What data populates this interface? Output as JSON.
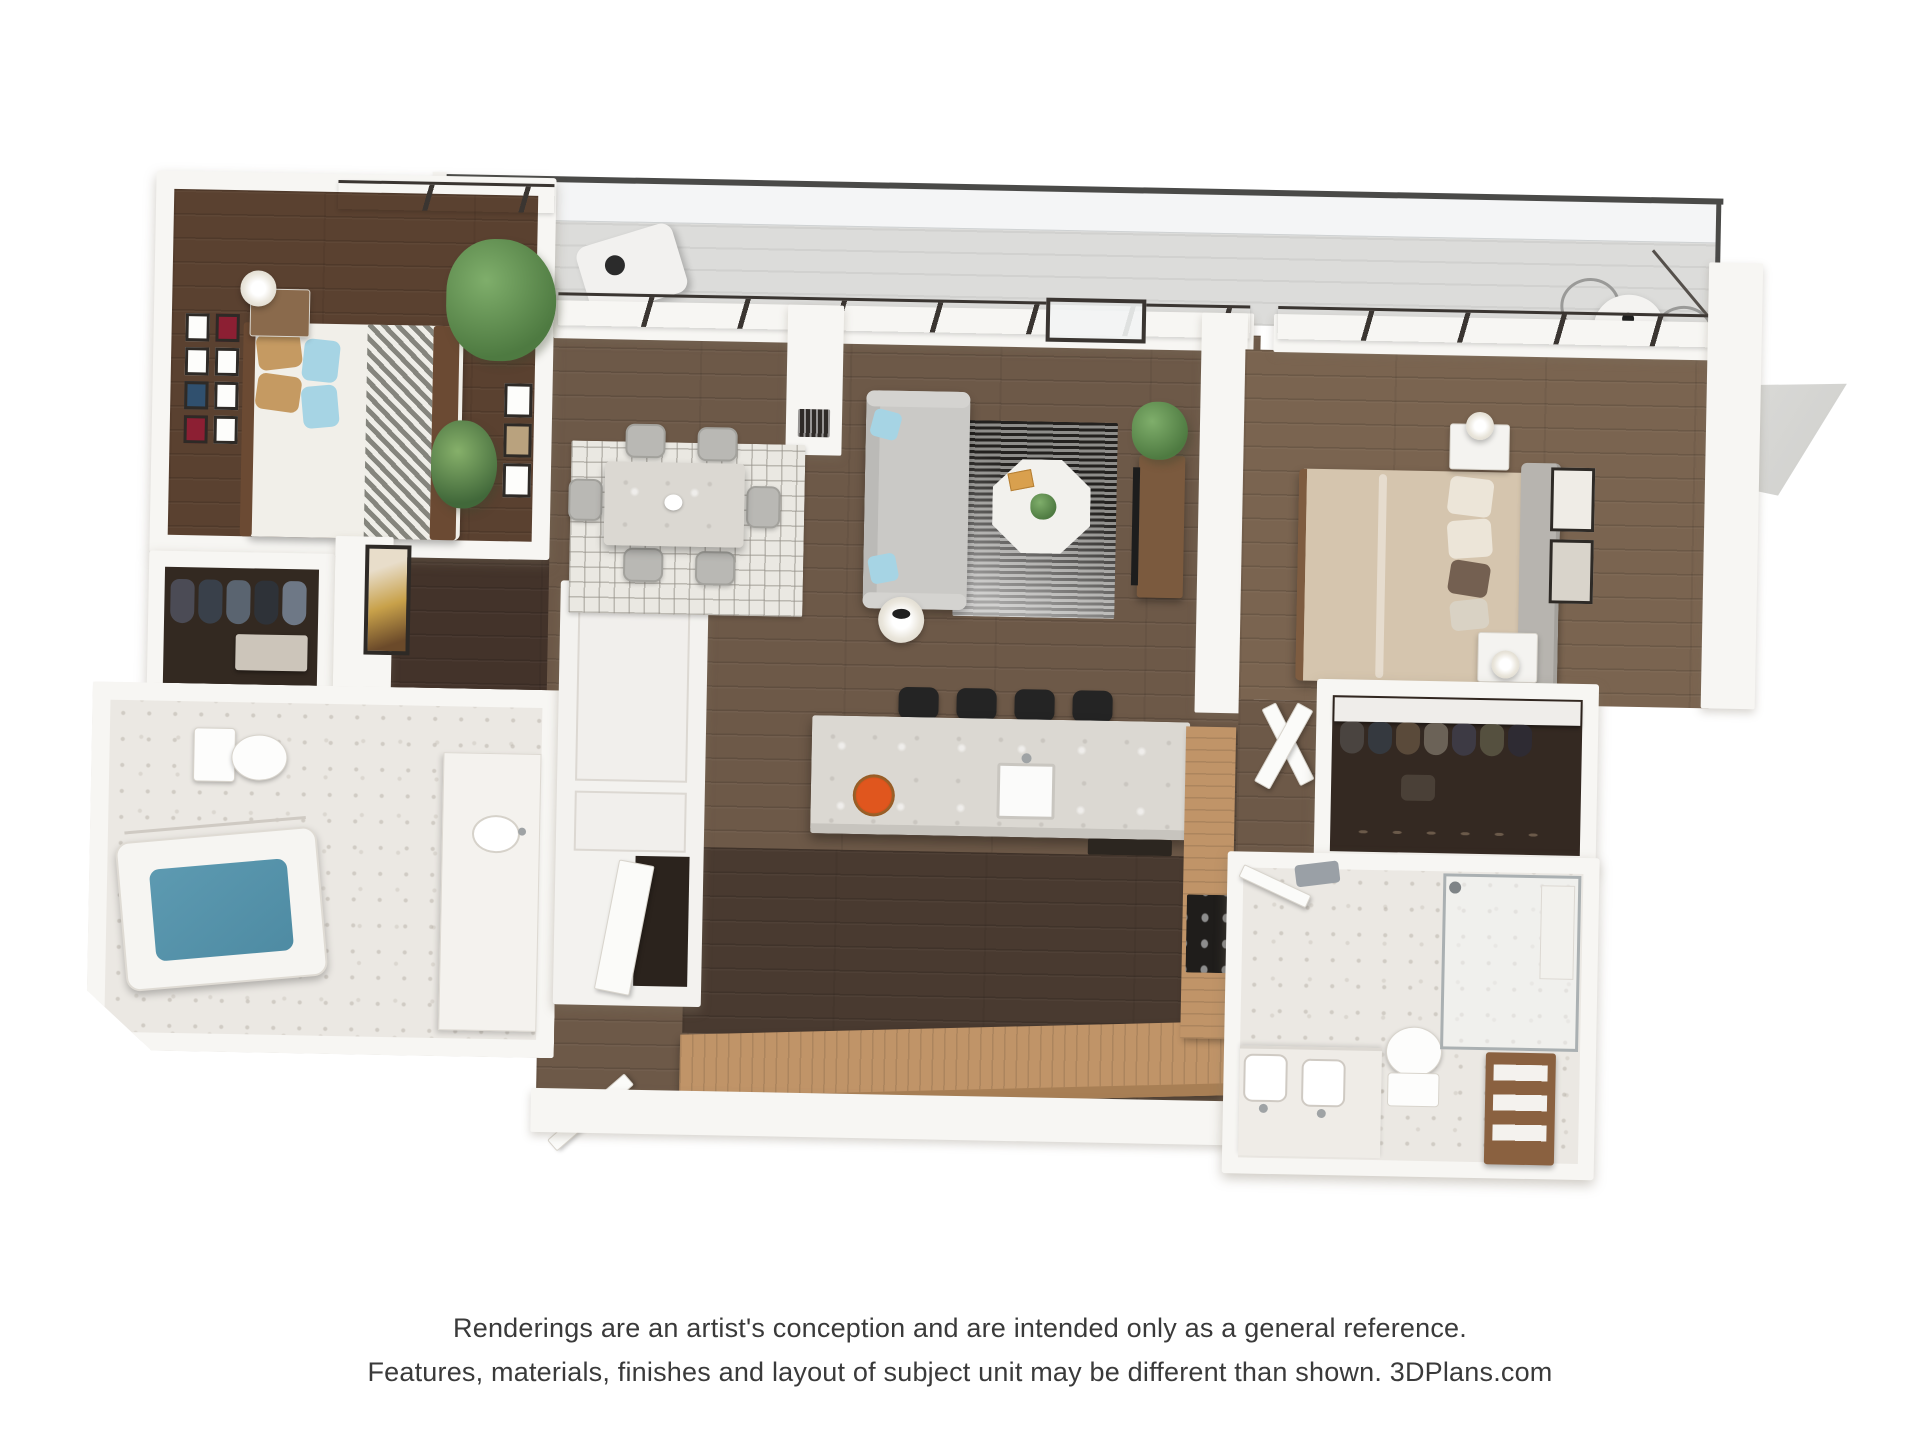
{
  "disclaimer": {
    "line1": "Renderings are an artist's conception and are intended only as a general reference.",
    "line2": "Features, materials, finishes and layout of subject unit may be different than shown. 3DPlans.com"
  },
  "colors": {
    "wall": "#f7f6f3",
    "wallShade": "#e7e4df",
    "floorBedroom": "#5a4130",
    "floorMain": "#6d5948",
    "floorKitchen": "#493a30",
    "floorMaster": "#7a6450",
    "floorCloset": "#332921",
    "floorHall": "#43332a",
    "tile": "#ebe8e3",
    "balcony": "#dcdcda",
    "counterTan": "#c09468",
    "counterTanDark": "#a87f55",
    "islandMarble": "#dbd8d2",
    "sofaGray": "#cac9c6",
    "chairGray": "#b9b8b4",
    "pillowBlue": "#a6d4e4",
    "pillowTan": "#c59a62",
    "bedWhite": "#f1efe9",
    "duvetTan": "#d5c5ae",
    "headboardGray": "#b7b4af",
    "tubBlue": "#4e8ba3",
    "stoolBlack": "#242424",
    "rugDark": "#23211f",
    "rugLight": "#8e8d8a",
    "rugDining": "#eae8e2",
    "plantGreen": "#4e7a41",
    "plantLight": "#7fae6b",
    "flowerOrange": "#e0561e",
    "frameDark": "#2e2a26",
    "windowFrame": "#3a3531",
    "glass": "#eef0f0",
    "woodBrown": "#7b5a3e",
    "artGold": "#c8a14a",
    "railDark": "#4a4a48",
    "textColor": "#3a3a3a"
  }
}
